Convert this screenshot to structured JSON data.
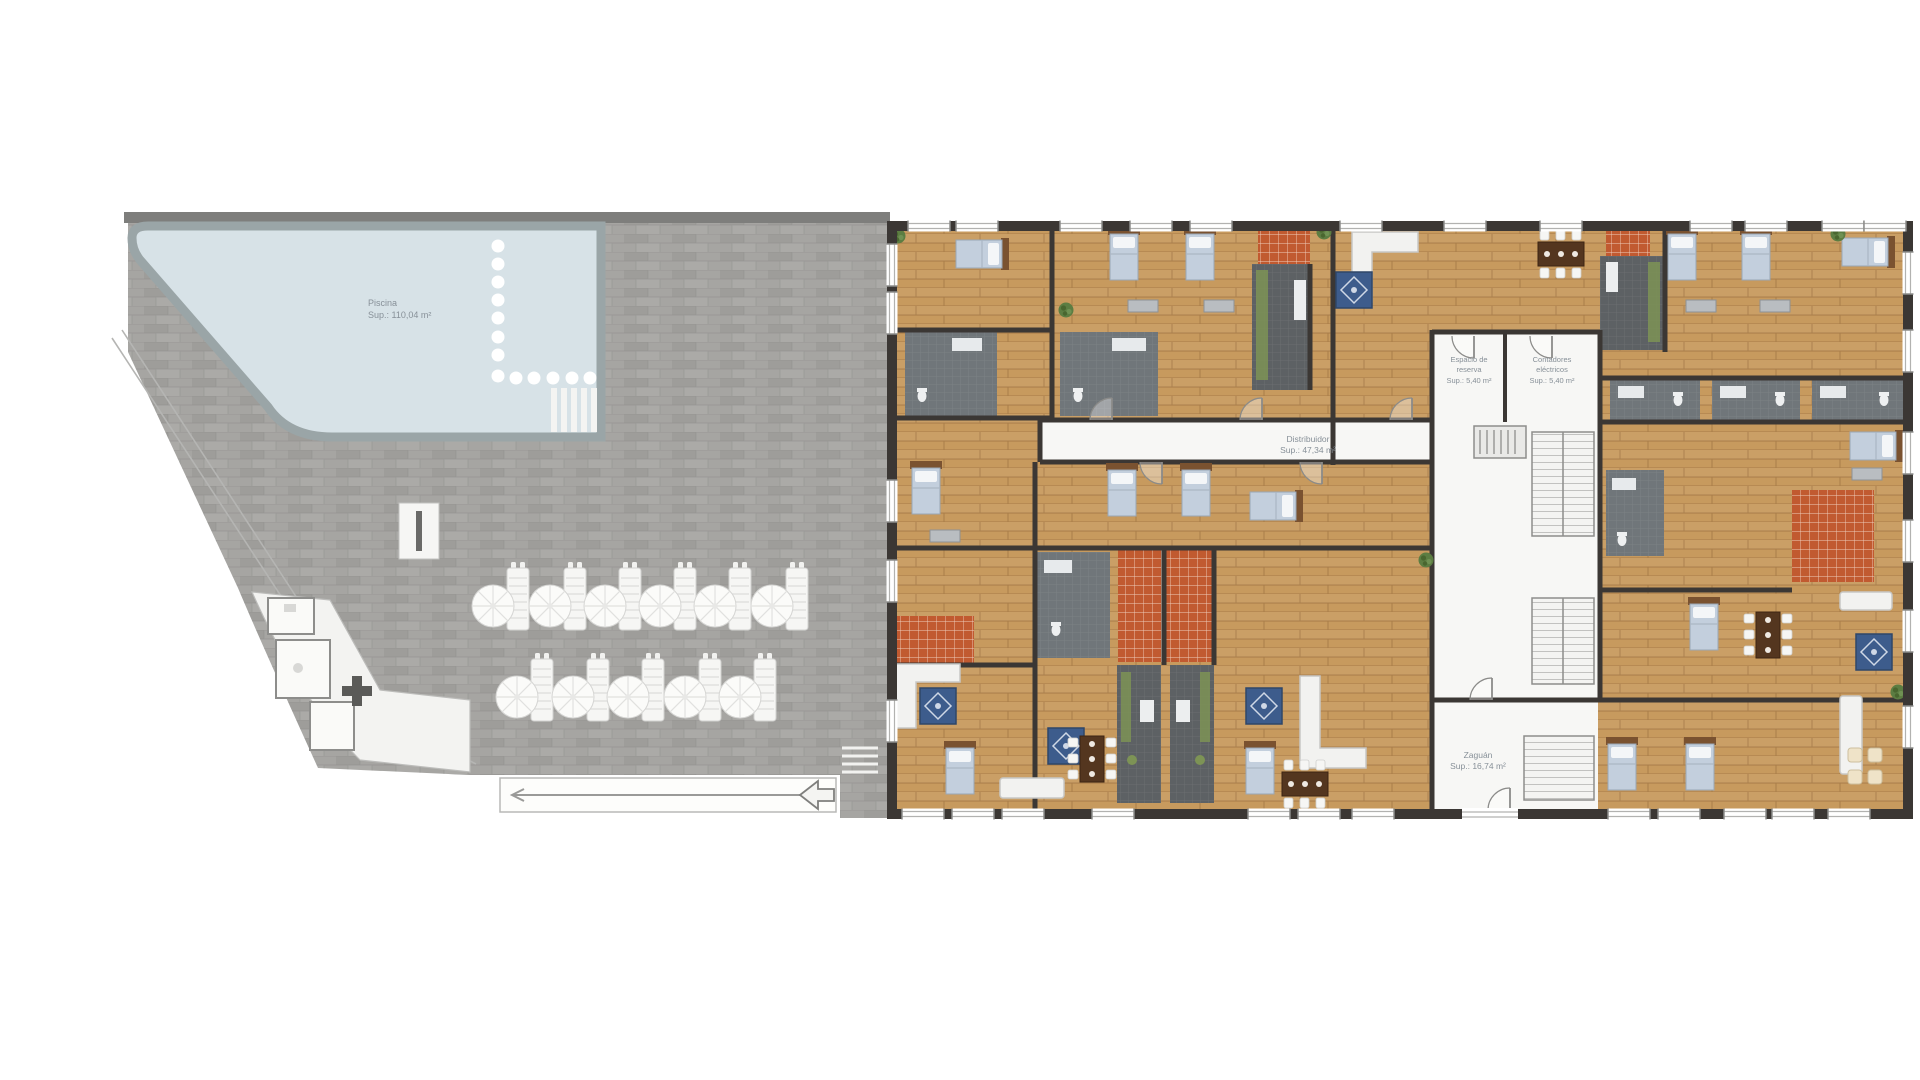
{
  "plan": {
    "type": "floor-plan",
    "labels": {
      "piscina": {
        "title": "Piscina",
        "area": "Sup.: 110,04 m²"
      },
      "espacio": {
        "line1": "Espacio de",
        "line2": "reserva",
        "area": "Sup.: 5,40 m²"
      },
      "contadores": {
        "line1": "Contadores",
        "line2": "eléctricos",
        "area": "Sup.: 5,40 m²"
      },
      "distribuidor": {
        "title": "Distribuidor",
        "area": "Sup.: 47,34 m²"
      },
      "zaguan": {
        "title": "Zaguán",
        "area": "Sup.: 16,74 m²"
      }
    },
    "sun_loungers": {
      "top_row": 6,
      "bottom_row": 5
    },
    "colors": {
      "page": "#ffffff",
      "paver": "#a6a5a2",
      "paverWall": "#7e7e7c",
      "pool": "#d7e2e7",
      "poolBorder": "#9aa5a7",
      "wood": "#c79a5e",
      "wall": "#3b3734",
      "whiteRoom": "#f7f7f5",
      "kitchen": "#5d6164",
      "bath": "#70767a",
      "terracotta": "#c15a30",
      "bed": "#c3cfdd",
      "bedFrame": "#7a5230",
      "rug": "#3d5c8c",
      "sofa": "#f2f2f0",
      "table": "#54361f",
      "plant": "#5c7d42",
      "counter": "#7d9355",
      "labelText": "#879098"
    }
  }
}
